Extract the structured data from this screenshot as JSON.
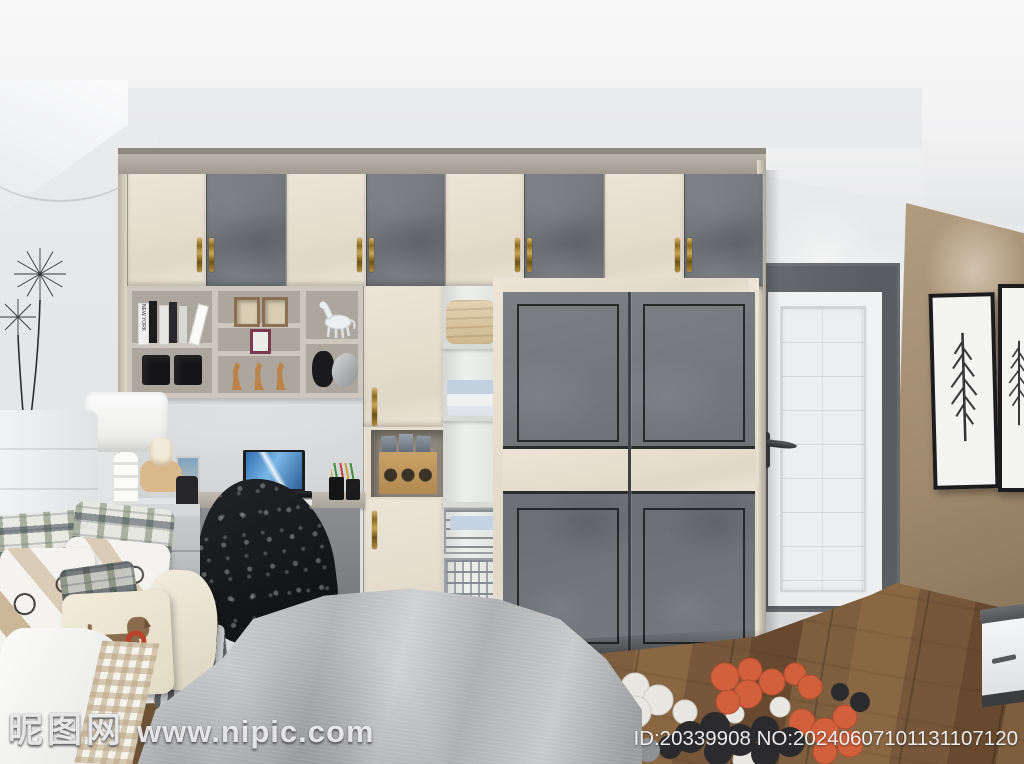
{
  "watermark": {
    "site_name": "昵图网",
    "site_url": "www.nipic.com",
    "id_label": "ID:20339908 NO:20240607101131107120"
  },
  "shelf": {
    "book_spine": "NEW YORK"
  },
  "colors": {
    "ceiling": "#f2f2f3",
    "wall_white": "#e2e4e6",
    "wall_brown": "#a18a6e",
    "cabinet_cream": "#ece4d6",
    "cabinet_gray": "#6c7074",
    "frame_greige": "#b3aba1",
    "door_frame_dark": "#595c60",
    "door_white": "#eceef0",
    "floor_wood": "#77573a",
    "rug_orange": "#d2603c",
    "rug_black": "#2b2b2d",
    "rug_white": "#e9e7e1",
    "rug_gray": "#8e9093",
    "duvet_gray": "#c6c7c9",
    "brass": "#b08d3e"
  }
}
